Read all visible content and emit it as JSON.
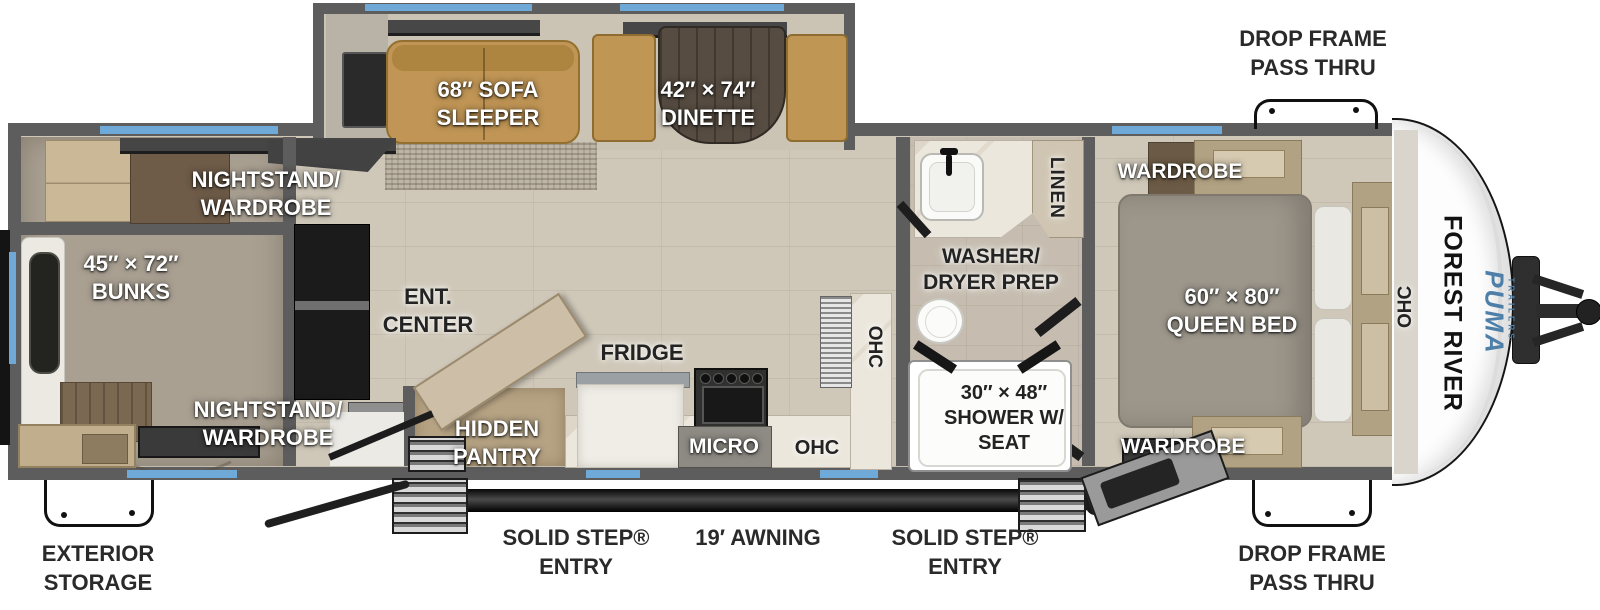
{
  "colors": {
    "accent_blue": "#6fa9d8",
    "wall_gray": "#5d5d5d",
    "brand_blue": "#4d7fa8",
    "label_white": "#ffffff",
    "label_black": "#232323"
  },
  "interior": {
    "sofa_sleeper": "68″ SOFA\nSLEEPER",
    "dinette": "42″ × 74″\nDINETTE",
    "nightstand_wardrobe_rear_top": "NIGHTSTAND/\nWARDROBE",
    "bunks": "45″ × 72″\nBUNKS",
    "nightstand_wardrobe_rear_bottom": "NIGHTSTAND/\nWARDROBE",
    "ent_center": "ENT.\nCENTER",
    "hidden_pantry": "HIDDEN\nPANTRY",
    "fridge": "FRIDGE",
    "micro": "MICRO",
    "ohc_kitchen_vertical": "OHC",
    "ohc_kitchen": "OHC",
    "washer_dryer_prep": "WASHER/\nDRYER PREP",
    "linen": "LINEN",
    "shower": "30″ × 48″\nSHOWER W/\nSEAT",
    "wardrobe_front_top": "WARDROBE",
    "wardrobe_front_bottom": "WARDROBE",
    "queen_bed": "60″ × 80″\nQUEEN BED",
    "ohc_bedroom": "OHC"
  },
  "brand": {
    "manufacturer": "FOREST RIVER",
    "model": "PUMA",
    "series": "TRAILERS"
  },
  "exterior": {
    "drop_frame_pass_thru_top": "DROP FRAME\nPASS THRU",
    "drop_frame_pass_thru_bottom": "DROP FRAME\nPASS THRU",
    "exterior_storage": "EXTERIOR\nSTORAGE",
    "solid_step_entry_left": "SOLID STEP®\nENTRY",
    "awning": "19′ AWNING",
    "solid_step_entry_right": "SOLID STEP®\nENTRY"
  }
}
